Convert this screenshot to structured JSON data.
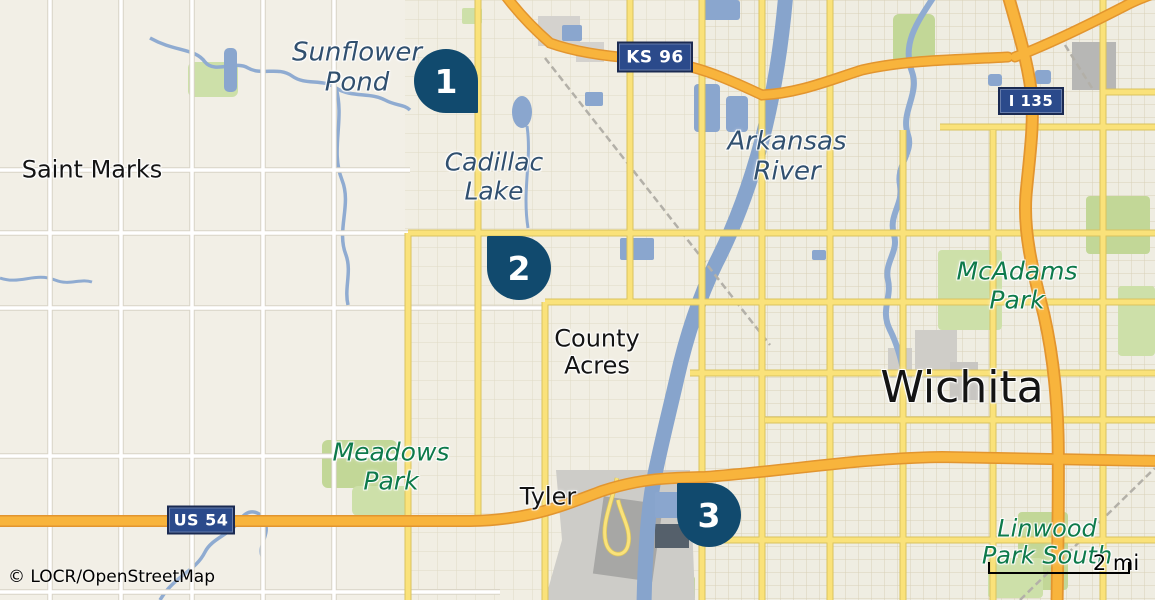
{
  "attribution": "© LOCR/OpenStreetMap",
  "scale": {
    "label": "2 mi"
  },
  "markers": [
    {
      "number": "1",
      "icon": "map-pin"
    },
    {
      "number": "2",
      "icon": "map-pin"
    },
    {
      "number": "3",
      "icon": "map-pin"
    }
  ],
  "road_shields": [
    {
      "label": "KS 96"
    },
    {
      "label": "I 135"
    },
    {
      "label": "US 54"
    }
  ],
  "place_labels": {
    "saint_marks": "Saint Marks",
    "county_acres_line1": "County",
    "county_acres_line2": "Acres",
    "tyler": "Tyler",
    "wichita": "Wichita"
  },
  "water_labels": {
    "sunflower_pond_line1": "Sunflower",
    "sunflower_pond_line2": "Pond",
    "cadillac_lake_line1": "Cadillac",
    "cadillac_lake_line2": "Lake",
    "arkansas_river_line1": "Arkansas",
    "arkansas_river_line2": "River"
  },
  "park_labels": {
    "mcadams_line1": "McAdams",
    "mcadams_line2": "Park",
    "meadows_line1": "Meadows",
    "meadows_line2": "Park",
    "linwood_line1": "Linwood",
    "linwood_line2": "Park South"
  },
  "colors": {
    "marker": "#114A6E",
    "shield_background": "#2B4A8B",
    "water": "#8AA6CE",
    "highway": "#F8B43C",
    "secondary_road": "#FAE27A",
    "park_label": "#0E7A4B",
    "water_label": "#31506F",
    "background": "#F2EFE6"
  }
}
